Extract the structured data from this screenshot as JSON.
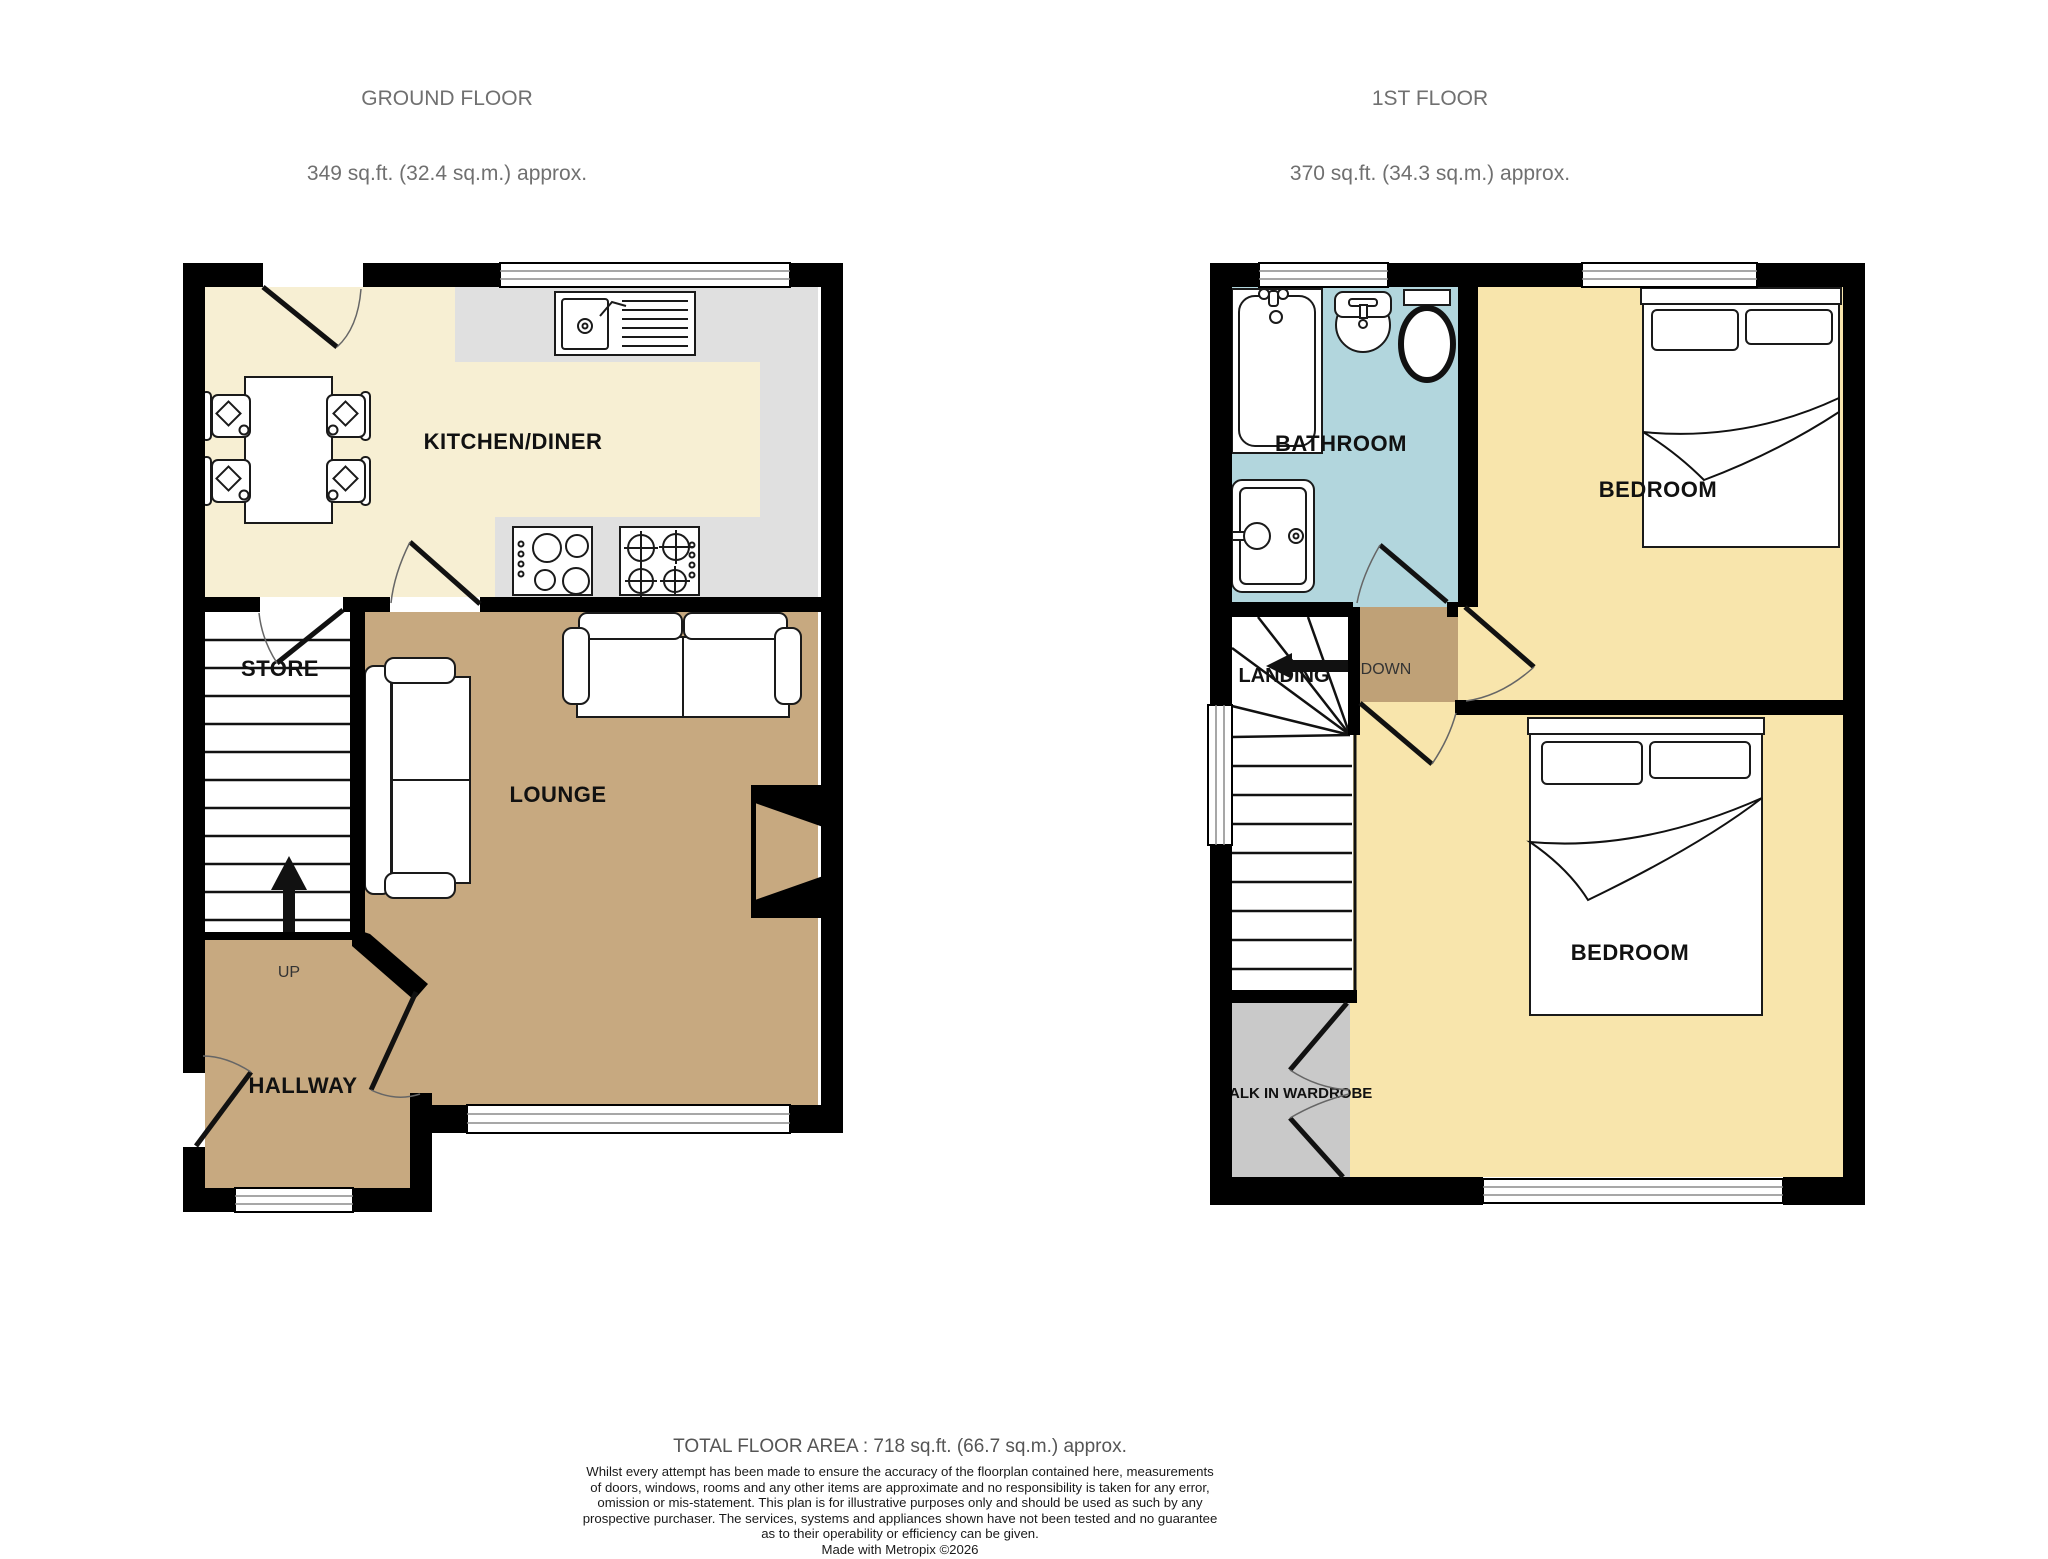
{
  "headers": {
    "ground": {
      "title": "GROUND FLOOR",
      "area": "349 sq.ft. (32.4 sq.m.) approx."
    },
    "first": {
      "title": "1ST FLOOR",
      "area": "370 sq.ft. (34.3 sq.m.) approx."
    }
  },
  "rooms": {
    "kitchen": "KITCHEN/DINER",
    "store": "STORE",
    "lounge": "LOUNGE",
    "hallway": "HALLWAY",
    "bathroom": "BATHROOM",
    "landing": "LANDING",
    "bedroom_top": "BEDROOM",
    "bedroom_bottom": "BEDROOM",
    "wardrobe": "WALK IN WARDROBE"
  },
  "stairs": {
    "up": "UP",
    "down": "DOWN"
  },
  "footer": {
    "total": "TOTAL FLOOR AREA : 718 sq.ft. (66.7 sq.m.) approx.",
    "disclaimer_lines": [
      "Whilst every attempt has been made to ensure the accuracy of the floorplan contained here, measurements",
      "of doors, windows, rooms and any other items are approximate and no responsibility is taken for any error,",
      "omission or mis-statement. This plan is for illustrative purposes only and should be used as such by any",
      "prospective purchaser. The services, systems and appliances shown have not been tested and no guarantee",
      "as to their operability or efficiency can be given.",
      "Made with Metropix ©2026"
    ]
  },
  "colors": {
    "kitchen_floor": "#F7EFD3",
    "counter": "#E0E0E0",
    "lounge_floor": "#C7A980",
    "lobby_floor": "#BFA177",
    "bedroom_floor": "#F8E5AC",
    "bathroom_floor": "#B2D6DD",
    "wardrobe_floor": "#C9C9C9",
    "store_floor": "#FFFFFF",
    "wall": "#000000",
    "title_text": "#707070"
  }
}
